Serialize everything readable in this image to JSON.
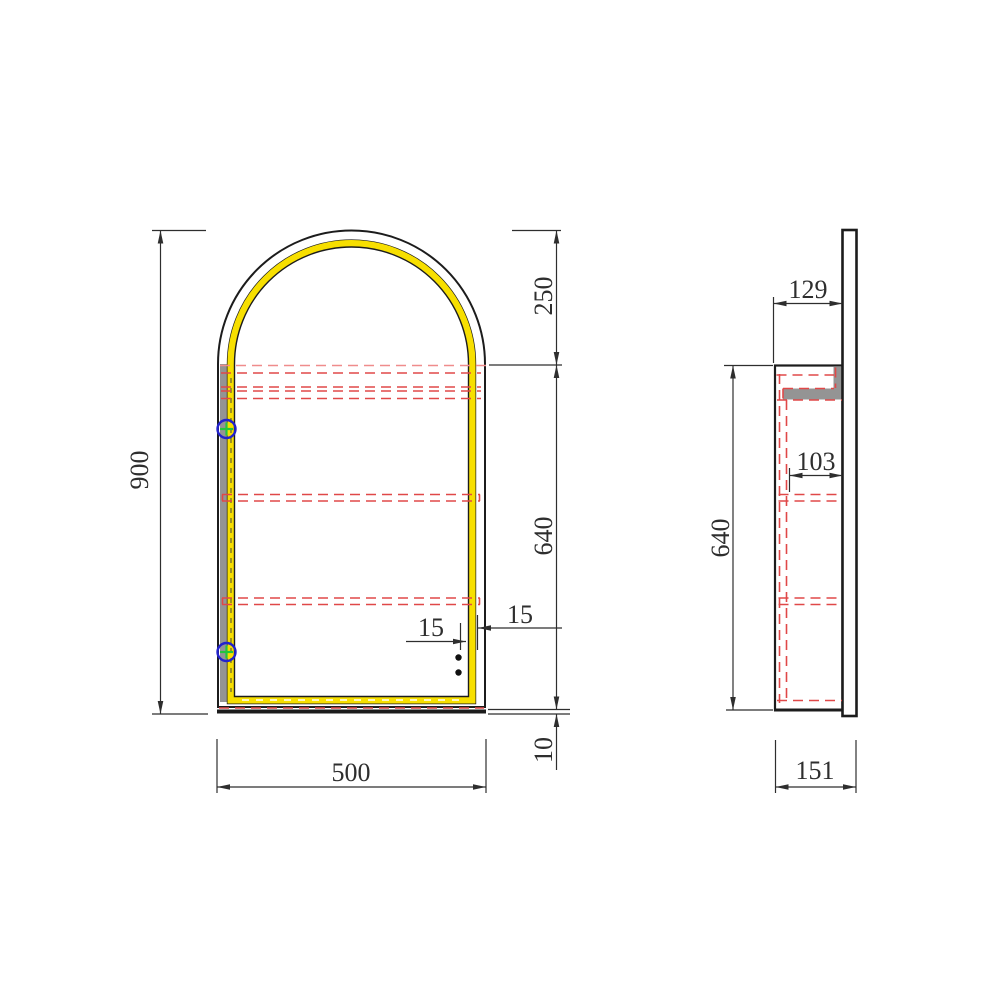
{
  "drawing": {
    "title": "Arched LED mirror cabinet technical drawing",
    "front_view": {
      "overall_height": "900",
      "arch_height": "250",
      "body_height": "640",
      "bottom_reveal": "10",
      "width": "500",
      "frame_left": "15",
      "frame_right": "15"
    },
    "side_view": {
      "cabinet_depth": "129",
      "inner_clear_depth": "103",
      "body_height": "640",
      "total_depth": "151"
    },
    "colors": {
      "led_strip_yellow": "#f7df00",
      "hidden_line_red": "#e04848",
      "hidden_line_pink": "#ef8c8c",
      "hinge_blue": "#2323cc",
      "hinge_green": "#25c33e",
      "panel_gray": "#949494",
      "outline_black": "#1c1c1c",
      "dimension_gray": "#2e2e2e"
    }
  }
}
